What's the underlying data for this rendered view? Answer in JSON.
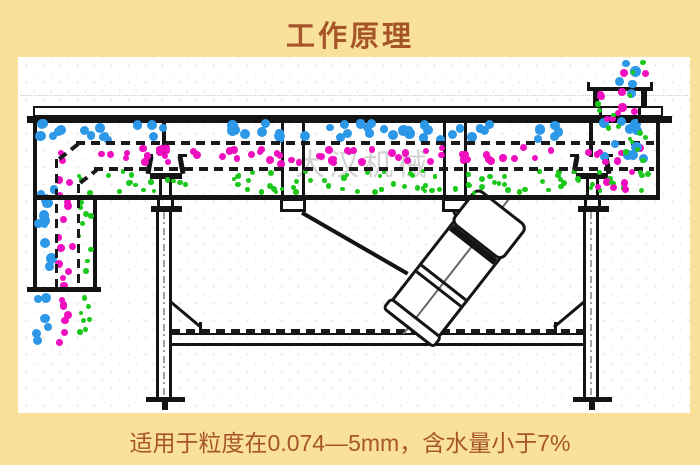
{
  "header": {
    "title": "工作原理"
  },
  "footer": {
    "caption": "适用于粒度在0.074—5mm，含水量小于7%"
  },
  "watermark": {
    "text": "大汉机械"
  },
  "colors": {
    "page_background": "#FAE199",
    "panel_background": "#FFFFFF",
    "text": "#A6552B",
    "line": "#141414",
    "coarse_particles": "#2D97E8",
    "medium_particles": "#EF0FBF",
    "fine_particles": "#1DC81D"
  },
  "particles": {
    "regions": [
      {
        "name": "deck-top-coarse",
        "color": "coarse_particles",
        "x": 58,
        "y": 123,
        "w": 588,
        "h": 17,
        "count": 58,
        "d": 9,
        "seed": 11,
        "front": false
      },
      {
        "name": "deck-mid-medium",
        "color": "medium_particles",
        "x": 100,
        "y": 147,
        "w": 546,
        "h": 17,
        "count": 66,
        "d": 7,
        "seed": 22,
        "front": false
      },
      {
        "name": "deck-bottom-fine",
        "color": "fine_particles",
        "x": 96,
        "y": 171,
        "w": 552,
        "h": 22,
        "count": 95,
        "d": 5,
        "seed": 33,
        "front": false
      },
      {
        "name": "left-channel-coarse",
        "color": "coarse_particles",
        "x": 38,
        "y": 122,
        "w": 16,
        "h": 164,
        "count": 17,
        "d": 9,
        "seed": 44,
        "front": false
      },
      {
        "name": "left-channel-medium",
        "color": "medium_particles",
        "x": 58,
        "y": 150,
        "w": 16,
        "h": 136,
        "count": 15,
        "d": 7,
        "seed": 55,
        "front": false
      },
      {
        "name": "left-channel-fine",
        "color": "fine_particles",
        "x": 79,
        "y": 174,
        "w": 12,
        "h": 112,
        "count": 13,
        "d": 5,
        "seed": 66,
        "front": false
      },
      {
        "name": "discharge-coarse",
        "color": "coarse_particles",
        "x": 36,
        "y": 295,
        "w": 13,
        "h": 55,
        "count": 6,
        "d": 9,
        "seed": 77,
        "front": false
      },
      {
        "name": "discharge-medium",
        "color": "medium_particles",
        "x": 58,
        "y": 295,
        "w": 15,
        "h": 50,
        "count": 7,
        "d": 7,
        "seed": 88,
        "front": false
      },
      {
        "name": "discharge-fine",
        "color": "fine_particles",
        "x": 80,
        "y": 295,
        "w": 12,
        "h": 45,
        "count": 7,
        "d": 5,
        "seed": 99,
        "front": false
      },
      {
        "name": "feed-coarse",
        "color": "coarse_particles",
        "x": 600,
        "y": 58,
        "w": 44,
        "h": 132,
        "count": 15,
        "d": 9,
        "seed": 111,
        "front": true
      },
      {
        "name": "feed-medium",
        "color": "medium_particles",
        "x": 596,
        "y": 58,
        "w": 52,
        "h": 136,
        "count": 19,
        "d": 7,
        "seed": 122,
        "front": true
      },
      {
        "name": "feed-fine",
        "color": "fine_particles",
        "x": 597,
        "y": 58,
        "w": 50,
        "h": 134,
        "count": 17,
        "d": 5,
        "seed": 133,
        "front": true
      }
    ]
  }
}
